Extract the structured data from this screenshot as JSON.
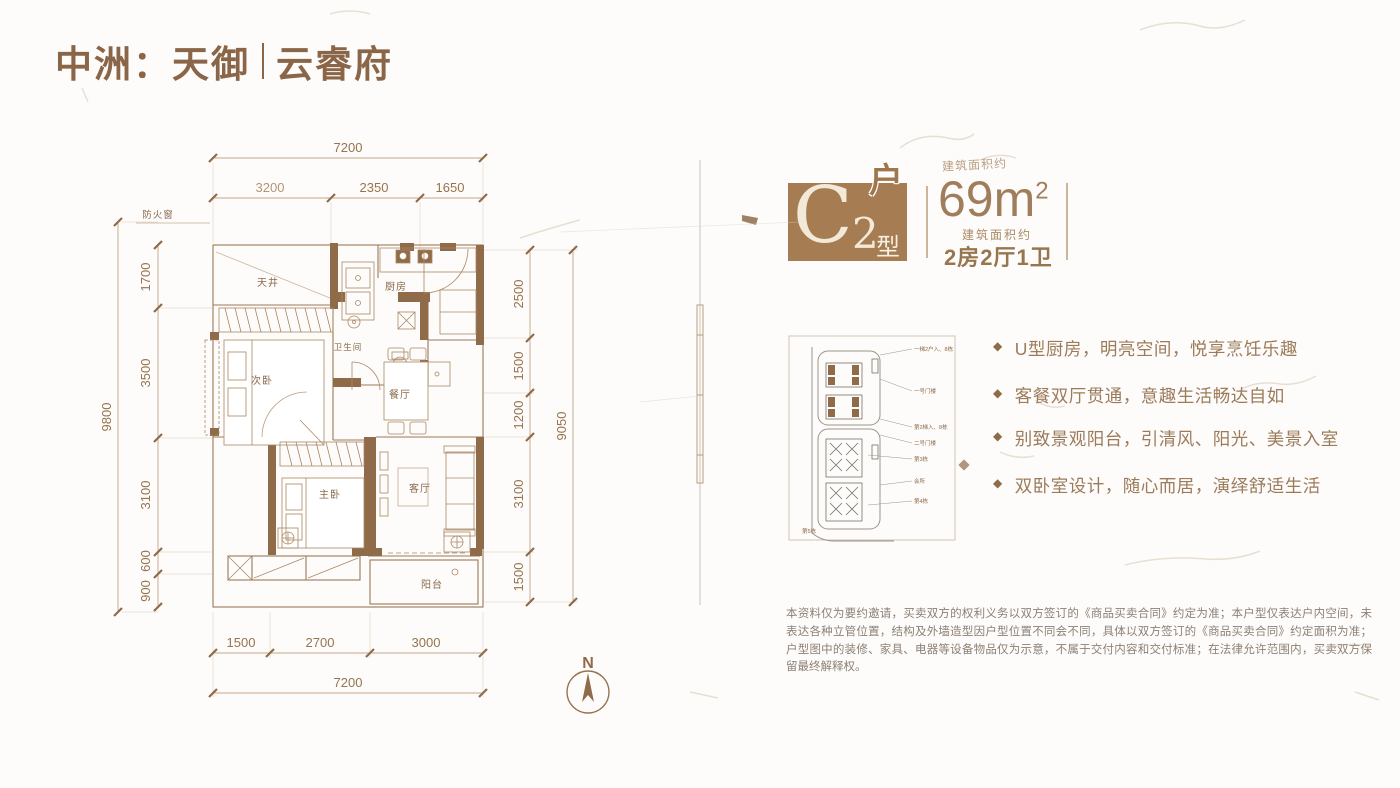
{
  "brand": {
    "logo_left": "中洲：天御",
    "logo_right": "云睿府"
  },
  "unit_badge": {
    "letter": "C",
    "number": "2",
    "suffix_top": "户",
    "suffix_bottom": "型"
  },
  "area": {
    "note_ghost": "建筑面积约",
    "value": "69",
    "unit": "m",
    "sup": "2",
    "note": "建筑面积约",
    "layout": "2房2厅1卫"
  },
  "features": {
    "marker": "◆",
    "item1": "U型厨房，明亮空间，悦享烹饪乐趣",
    "item2": "客餐双厅贯通，意趣生活畅达自如",
    "item3": "别致景观阳台，引清风、阳光、美景入室",
    "item4": "双卧室设计，随心而居，演绎舒适生活"
  },
  "floor_plan": {
    "rooms": {
      "light_well": "天井",
      "kitchen": "厨房",
      "bathroom": "卫生间",
      "bedroom2": "次卧",
      "dining": "餐厅",
      "bedroom1": "主卧",
      "living": "客厅",
      "balcony": "阳台"
    },
    "fire_window": "防火窗",
    "compass": "N",
    "dims": {
      "top_total": "7200",
      "top_seg1": "3200",
      "top_seg2": "2350",
      "top_seg3": "1650",
      "left_total": "9800",
      "left_seg1": "1700",
      "left_seg2": "3500",
      "left_seg3": "3100",
      "left_seg4": "600",
      "left_seg5": "900",
      "right_total": "9050",
      "right_seg1": "2500",
      "right_seg2": "1500",
      "right_seg3": "1200",
      "right_seg4": "3100",
      "right_seg5": "1500",
      "bottom_total": "7200",
      "bottom_seg1": "1500",
      "bottom_seg2": "2700",
      "bottom_seg3": "3000"
    }
  },
  "site_plan": {
    "labels": {
      "l1": "一梯2户入、8栋",
      "l2": "一号门楼",
      "l3": "第2梯入、8栋",
      "l4": "二号门楼",
      "l5": "第3栋",
      "l6": "会所",
      "l7": "第4栋",
      "l8": "第5栋"
    }
  },
  "disclaimer": "本资料仅为要约邀请，买卖双方的权利义务以双方签订的《商品买卖合同》约定为准；本户型仅表达户内空间，未表达各种立管位置，结构及外墙造型因户型位置不同会不同，具体以双方签订的《商品买卖合同》约定面积为准；户型图中的装修、家具、电器等设备物品仅为示意，不属于交付内容和交付标准；在法律允许范围内，买卖双方保留最终解释权。",
  "colors": {
    "brand_brown": "#8a6547",
    "badge_brown": "#a67c52",
    "accent_text": "#9c7b5b",
    "plan_line": "#a8845f",
    "wall_fill": "#8f6b49",
    "dim_text": "#96744f",
    "disclaimer_text": "#8d8076"
  }
}
